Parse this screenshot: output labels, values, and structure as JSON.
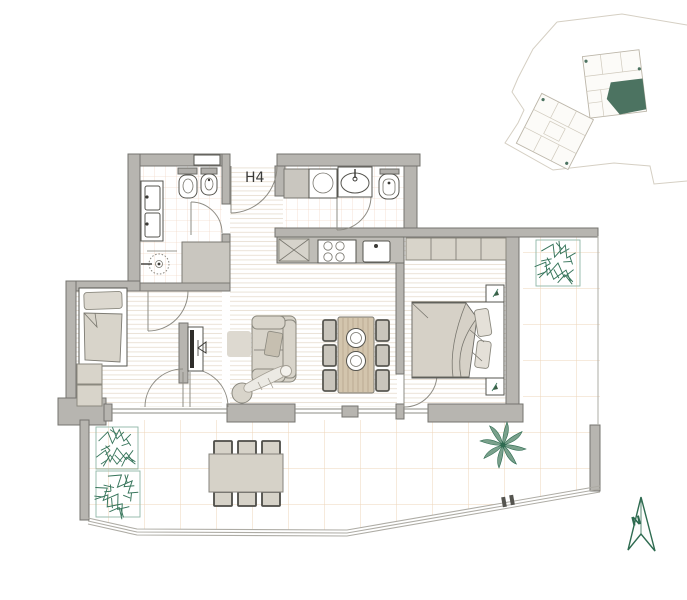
{
  "plan": {
    "unit_label": "H4",
    "north_label": "N",
    "palette": {
      "wall": "#b7b5b0",
      "wall_outline": "#75746f",
      "furniture_fill": "#d8d4ca",
      "fixture_outline": "#56554f",
      "wood_floor_line": "#eae2d6",
      "bathroom_tile_line": "#f2dbcb",
      "terrace_grid_line": "#eed4ba",
      "plant_green": "#37755b",
      "site_highlight_green": "#4c7361",
      "north_arrow_green": "#2e6b50"
    },
    "rooms": [
      "entrance-hall",
      "main-bathroom",
      "guest-bathroom",
      "kitchen",
      "living-dining-room",
      "study-bedroom",
      "bedroom",
      "terrace"
    ],
    "fixtures_and_furniture": [
      "double-vanity",
      "toilet",
      "bidet",
      "shower",
      "bathroom-cabinet",
      "washing-machine",
      "guest-sink",
      "guest-toilet",
      "kitchen-counter",
      "hob",
      "kitchen-sink",
      "sofa",
      "person-figure",
      "tv-unit",
      "pouf",
      "rug",
      "dining-table",
      "dining-chairs",
      "plates",
      "single-bed",
      "bedside-cabinet",
      "double-bed",
      "wardrobe",
      "nightstands",
      "potted-plants",
      "outdoor-table",
      "outdoor-chairs",
      "planters",
      "palm-plant",
      "railing"
    ],
    "site_plan": {
      "buildings_shown": 2,
      "highlighted_unit": "H4",
      "highlight_color": "#4c7361"
    }
  }
}
